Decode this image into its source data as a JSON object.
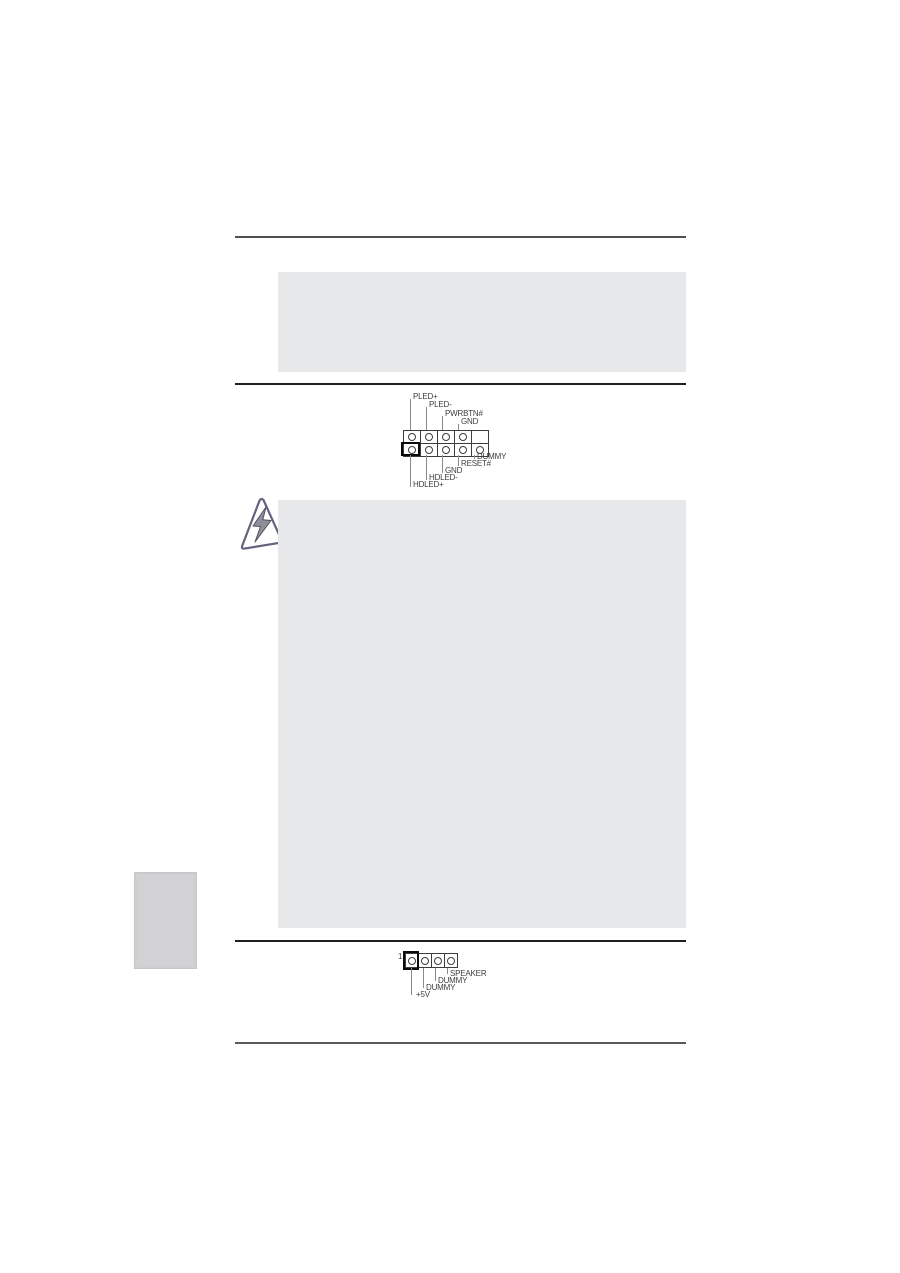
{
  "colors": {
    "placeholder_box": "#e7e8ea",
    "side_tab": "#d2d2d4",
    "divider_dark": "#1f1f1f",
    "divider_gray": "#4f4f4f",
    "diagram_ink": "#3d3d3d",
    "warning_outline": "#63637f",
    "warning_bolt": "#8f8f9c"
  },
  "system_panel_diagram": {
    "rows": 2,
    "columns": 5,
    "empty_cell": "top-right",
    "pin1_position": "bottom-left",
    "top_pin_labels": [
      "PLED+",
      "PLED-",
      "PWRBTN#",
      "GND"
    ],
    "bottom_pin_labels": [
      "DUMMY",
      "RESET#",
      "GND",
      "HDLED-",
      "HDLED+"
    ]
  },
  "speaker_diagram": {
    "pins": 4,
    "pin_number_label": "1",
    "pin1_position": "left",
    "pin_labels": [
      "SPEAKER",
      "DUMMY",
      "DUMMY",
      "+5V"
    ]
  },
  "icons": {
    "warning": "lightning-triangle-warning"
  }
}
